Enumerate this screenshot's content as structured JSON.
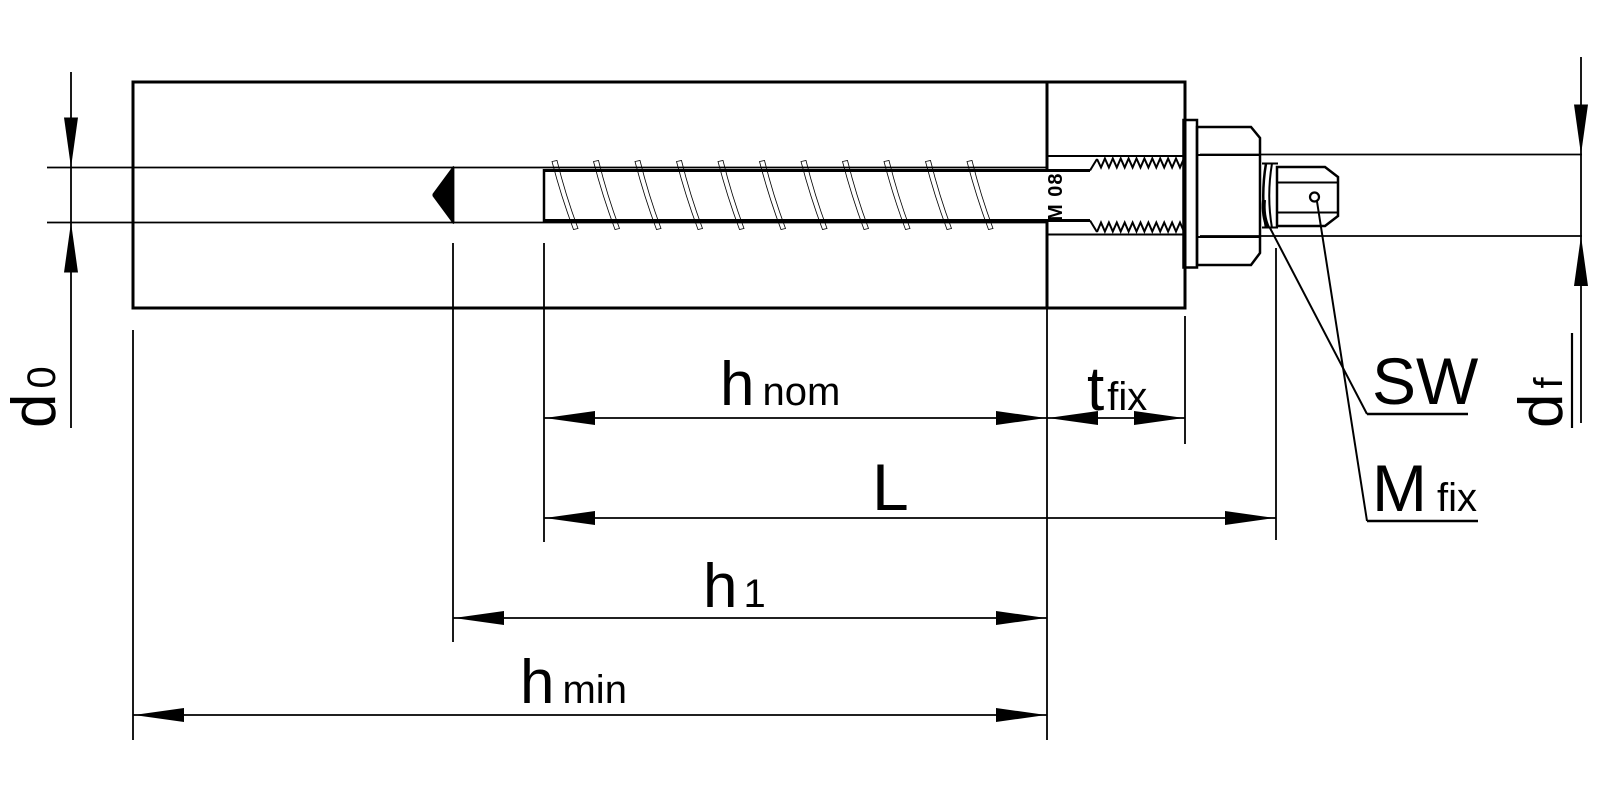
{
  "labels": {
    "d0": {
      "main": "d",
      "sub": "0"
    },
    "h_nom": {
      "main": "h",
      "sub": "nom"
    },
    "t_fix": {
      "main": "t",
      "sub": "fix"
    },
    "L": {
      "main": "L"
    },
    "h1": {
      "main": "h",
      "sub": "1"
    },
    "h_min": {
      "main": "h",
      "sub": "min"
    },
    "d_f": {
      "main": "d",
      "sub": "f"
    },
    "SW": {
      "main": "SW"
    },
    "M_fix": {
      "main": "M",
      "sub": "fix"
    },
    "screw_marking": "M 08"
  },
  "colors": {
    "line": "#000000",
    "background": "#ffffff"
  }
}
